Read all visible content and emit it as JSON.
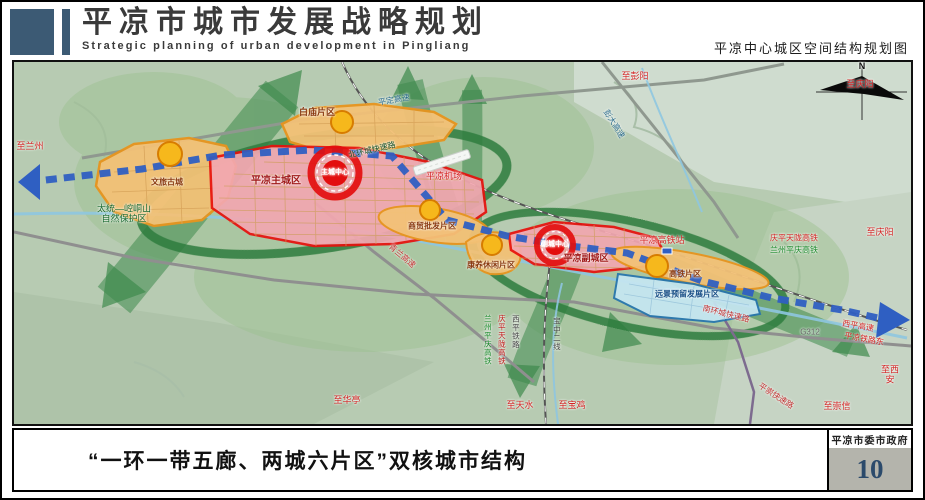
{
  "header": {
    "title_cn": "平凉市城市发展战略规划",
    "title_en": "Strategic planning of urban development in Pingliang",
    "subtitle": "平凉中心城区空间结构规划图"
  },
  "footer": {
    "caption": "“一环一带五廊、两城六片区”双核城市结构",
    "credit": "平凉市委市政府",
    "page": "10"
  },
  "colors": {
    "brand_navy": "#3c5a74",
    "zone_red_fill": "#f2a7b0",
    "zone_red_border": "#e8100c",
    "zone_orange_fill": "#f3c177",
    "zone_orange_border": "#e7941e",
    "zone_blue_fill": "#c6e6f2",
    "axis_blue": "#2f5fc2",
    "corridor_green": "#3e8a4d",
    "ring_green": "#2e7c3e",
    "terrain_green": "#b7cbb2",
    "page_number_blue": "#2b4a6b"
  },
  "map": {
    "compass": "N",
    "labels": [
      {
        "id": "to-lanzhou",
        "text": "至兰州",
        "x": 16,
        "y": 84,
        "color": "#d42424",
        "size": 9
      },
      {
        "id": "nature-reserve",
        "text": "太统—崆峒山\n自然保护区",
        "x": 110,
        "y": 152,
        "color": "#18692f",
        "size": 9
      },
      {
        "id": "zone-wenlu-gucheng",
        "text": "文旅古城",
        "x": 153,
        "y": 120,
        "color": "#8a3a10",
        "size": 8,
        "bold": true
      },
      {
        "id": "zone-baimiao",
        "text": "白庙片区",
        "x": 303,
        "y": 50,
        "color": "#8a3a10",
        "size": 9,
        "bold": true
      },
      {
        "id": "pingding-expressway",
        "text": "平定高速",
        "x": 380,
        "y": 38,
        "color": "#2a6b8a",
        "size": 8,
        "rot": -10
      },
      {
        "id": "north-ring-road",
        "text": "北环城快速路",
        "x": 358,
        "y": 88,
        "color": "#134f24",
        "size": 8,
        "rot": -13
      },
      {
        "id": "pingliang-airport",
        "text": "平凉机场",
        "x": 430,
        "y": 114,
        "color": "#d42424",
        "size": 9
      },
      {
        "id": "zone-main-city",
        "text": "平凉主城区",
        "x": 262,
        "y": 119,
        "color": "#a01818",
        "size": 10,
        "bold": true
      },
      {
        "id": "main-city-center",
        "text": "主城中心",
        "x": 321,
        "y": 111,
        "color": "#ffffff",
        "size": 7,
        "bold": true
      },
      {
        "id": "zone-trade",
        "text": "商贸批发片区",
        "x": 418,
        "y": 164,
        "color": "#8a3a10",
        "size": 8,
        "bold": true
      },
      {
        "id": "zone-leisure",
        "text": "康养休闲片区",
        "x": 477,
        "y": 203,
        "color": "#8a3a10",
        "size": 8,
        "bold": true
      },
      {
        "id": "qinglan-expressway",
        "text": "青兰高速",
        "x": 388,
        "y": 194,
        "color": "#c03030",
        "size": 8,
        "rot": 40
      },
      {
        "id": "zone-sub-city",
        "text": "平凉副城区",
        "x": 572,
        "y": 196,
        "color": "#a01818",
        "size": 9,
        "bold": true
      },
      {
        "id": "sub-city-center",
        "text": "副城中心",
        "x": 541,
        "y": 183,
        "color": "#ffffff",
        "size": 7,
        "bold": true
      },
      {
        "id": "hsr-station",
        "text": "平凉高铁站",
        "x": 648,
        "y": 178,
        "color": "#d42424",
        "size": 9
      },
      {
        "id": "qingping-tianlong-hsr",
        "text": "庆平天陇高铁",
        "x": 780,
        "y": 176,
        "color": "#d42424",
        "size": 8
      },
      {
        "id": "lanzhou-pingqing-hsr",
        "text": "兰州平庆高铁",
        "x": 780,
        "y": 188,
        "color": "#1a8a2a",
        "size": 8
      },
      {
        "id": "to-qingyang-top",
        "text": "至庆阳",
        "x": 846,
        "y": 22,
        "color": "#d42424",
        "size": 9
      },
      {
        "id": "to-qingyang",
        "text": "至庆阳",
        "x": 866,
        "y": 170,
        "color": "#d42424",
        "size": 9
      },
      {
        "id": "to-pengyang",
        "text": "至彭阳",
        "x": 621,
        "y": 14,
        "color": "#d42424",
        "size": 9
      },
      {
        "id": "pengda-expressway",
        "text": "彭大高速",
        "x": 600,
        "y": 62,
        "color": "#2a6b8a",
        "size": 8,
        "rot": 58
      },
      {
        "id": "xiping-expressway",
        "text": "西平高速",
        "x": 844,
        "y": 264,
        "color": "#d42424",
        "size": 8,
        "rot": 10
      },
      {
        "id": "pingliang-railway-east",
        "text": "平凉铁路东",
        "x": 850,
        "y": 277,
        "color": "#d42424",
        "size": 8,
        "rot": 10
      },
      {
        "id": "g312",
        "text": "G312",
        "x": 796,
        "y": 270,
        "color": "#666666",
        "size": 8
      },
      {
        "id": "south-ring-road",
        "text": "南环城快速路",
        "x": 712,
        "y": 252,
        "color": "#c03030",
        "size": 8,
        "rot": 14
      },
      {
        "id": "pingchong-expressway",
        "text": "平崇快速路",
        "x": 762,
        "y": 334,
        "color": "#c03030",
        "size": 8,
        "rot": 33
      },
      {
        "id": "to-chongxin",
        "text": "至崇信",
        "x": 823,
        "y": 344,
        "color": "#d42424",
        "size": 9
      },
      {
        "id": "to-xian",
        "text": "至西安",
        "x": 876,
        "y": 313,
        "color": "#d42424",
        "size": 9
      },
      {
        "id": "to-tianshui",
        "text": "至天水",
        "x": 506,
        "y": 343,
        "color": "#d42424",
        "size": 9
      },
      {
        "id": "to-baoji",
        "text": "至宝鸡",
        "x": 558,
        "y": 343,
        "color": "#d42424",
        "size": 9
      },
      {
        "id": "to-huating",
        "text": "至华亭",
        "x": 333,
        "y": 338,
        "color": "#d42424",
        "size": 9
      },
      {
        "id": "lanzhou-pingqing-hsr-v",
        "text": "兰州平庆高铁",
        "x": 473,
        "y": 278,
        "color": "#1a8a2a",
        "size": 7.5,
        "vertical": true
      },
      {
        "id": "qingping-tianlong-hsr-v",
        "text": "庆平天陇高铁",
        "x": 487,
        "y": 278,
        "color": "#c01818",
        "size": 7.5,
        "vertical": true
      },
      {
        "id": "xiping-railway-v",
        "text": "西平铁路",
        "x": 501,
        "y": 270,
        "color": "#444444",
        "size": 7.5,
        "vertical": true
      },
      {
        "id": "baozhong-line2-v",
        "text": "宝中二线",
        "x": 542,
        "y": 272,
        "color": "#444444",
        "size": 7.5,
        "vertical": true
      },
      {
        "id": "zone-reserved",
        "text": "远景预留发展片区",
        "x": 673,
        "y": 232,
        "color": "#174e86",
        "size": 8,
        "bold": true
      },
      {
        "id": "zone-hsr",
        "text": "高铁片区",
        "x": 671,
        "y": 212,
        "color": "#8a3a10",
        "size": 8,
        "bold": true
      },
      {
        "id": "compass-n",
        "text": "N",
        "x": 848,
        "y": 4,
        "color": "#111111",
        "size": 9,
        "bold": true
      }
    ]
  }
}
